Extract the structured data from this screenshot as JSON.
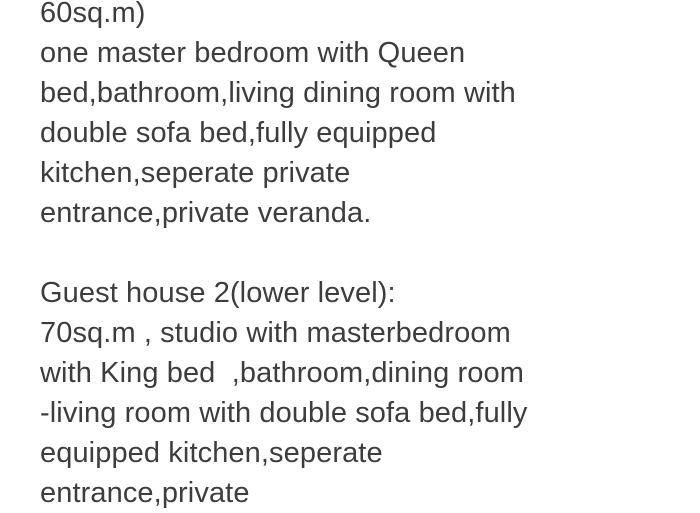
{
  "page": {
    "kind": "listing-description-text",
    "background_color": "#ffffff",
    "text_color": "#3d3d3d"
  },
  "description": {
    "lines": [
      "60sq.m)",
      "one master bedroom with Queen",
      "bed,bathroom,living dining room with",
      "double sofa bed,fully equipped",
      "kitchen,seperate private",
      "entrance,private veranda.",
      "",
      "Guest house 2(lower level):",
      "70sq.m , studio with masterbedroom",
      "with King bed  ,bathroom,dining room",
      "-living room with double sofa bed,fully",
      "equipped kitchen,seperate",
      "entrance,private"
    ]
  }
}
